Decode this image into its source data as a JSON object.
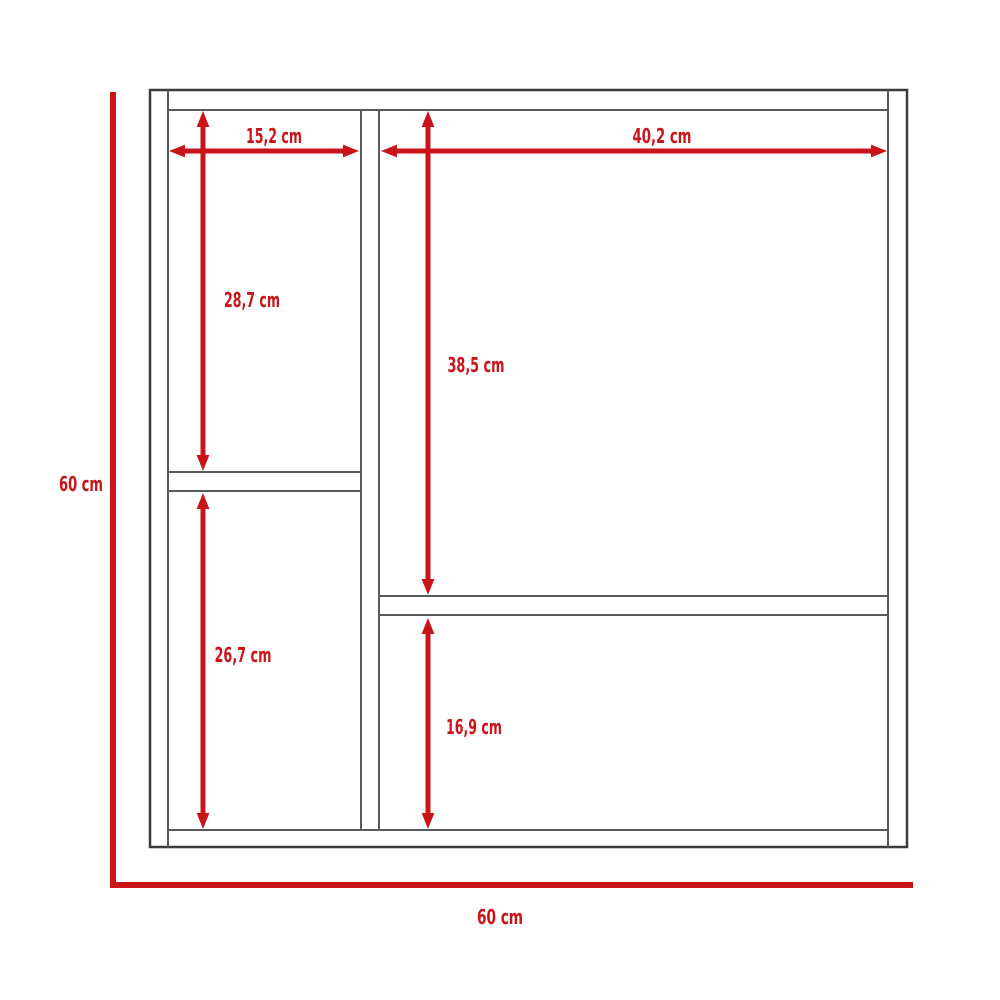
{
  "diagram": {
    "type": "furniture-dimension-diagram",
    "subject": "two-column cabinet front view with internal shelf measurements",
    "unit": "cm",
    "colors": {
      "dimension_red": "#c9141a",
      "cabinet_line_gray": "#5a5a5c",
      "background": "#ffffff"
    },
    "overall": {
      "height": {
        "label": "60 cm",
        "value_cm": 60
      },
      "width": {
        "label": "60 cm",
        "value_cm": 60
      }
    },
    "dimensions": {
      "left_compartment_width": {
        "label": "15,2 cm",
        "value_cm": 15.2
      },
      "right_compartment_width": {
        "label": "40,2 cm",
        "value_cm": 40.2
      },
      "left_upper_compartment_height": {
        "label": "28,7 cm",
        "value_cm": 28.7
      },
      "right_upper_compartment_height": {
        "label": "38,5 cm",
        "value_cm": 38.5
      },
      "left_lower_compartment_height": {
        "label": "26,7 cm",
        "value_cm": 26.7
      },
      "right_lower_compartment_height": {
        "label": "16,9 cm",
        "value_cm": 16.9
      }
    }
  }
}
